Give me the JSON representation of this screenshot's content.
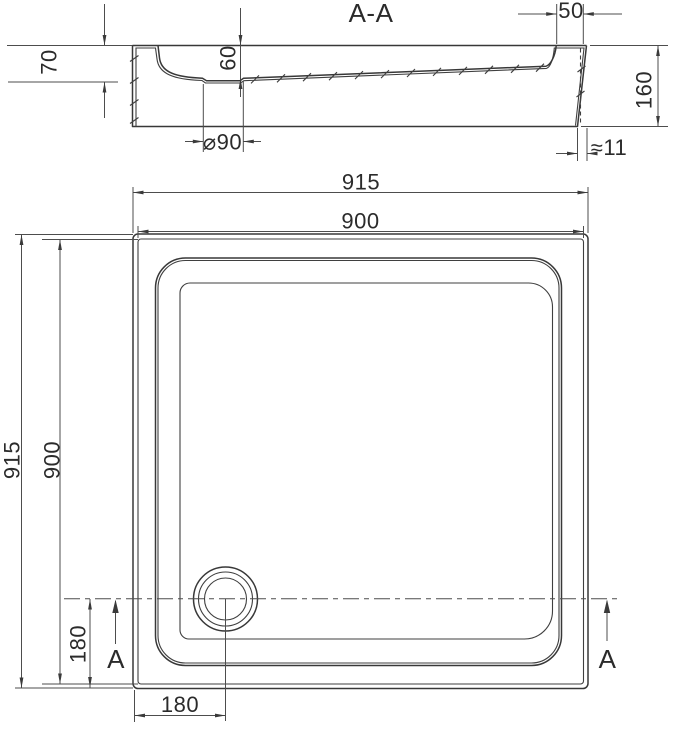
{
  "page": {
    "background": "#ffffff",
    "line_color": "#383838",
    "dim_color": "#4d4d4d"
  },
  "section_view": {
    "title": "A-A",
    "dims": {
      "edge_depth": "70",
      "drain_depth": "60",
      "drain_diameter": "⌀90",
      "rim_width": "50",
      "overall_height": "160",
      "base_offset": "≈11"
    }
  },
  "plan_view": {
    "dims": {
      "overall_width": "915",
      "inner_width": "900",
      "overall_height": "915",
      "inner_height": "900",
      "drain_offset_left": "180",
      "drain_offset_bottom": "180"
    },
    "section_markers": {
      "left": "A",
      "right": "A"
    }
  }
}
